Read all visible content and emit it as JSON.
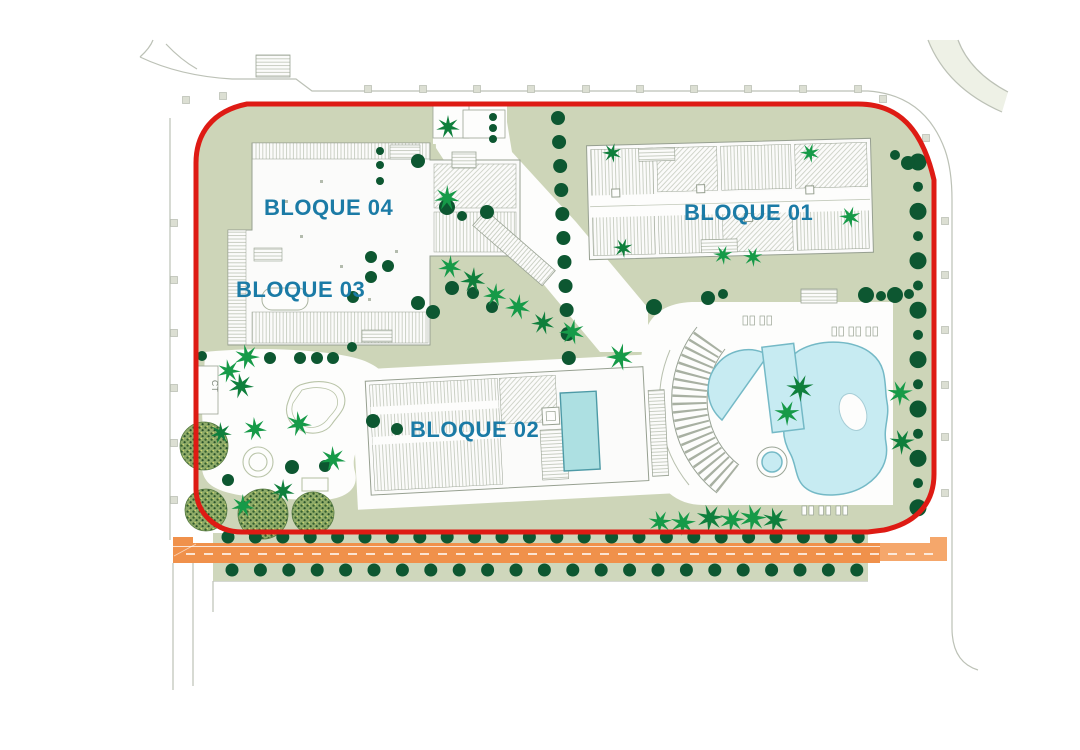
{
  "plan": {
    "buildings": [
      {
        "id": "bloque01",
        "label": "BLOQUE 01"
      },
      {
        "id": "bloque02",
        "label": "BLOQUE 02"
      },
      {
        "id": "bloque03",
        "label": "BLOQUE 03"
      },
      {
        "id": "bloque04",
        "label": "BLOQUE 04"
      }
    ],
    "annotations": {
      "ct_label": "CT"
    },
    "colors": {
      "boundary_red": "#de1b14",
      "label_blue": "#1b7ba6",
      "sage_green": "#cdd5b8",
      "pool_cyan": "#c7ebf2",
      "rooftop_pool_cyan": "#ade0e2",
      "road_orange": "#f0914b",
      "road_orange_light": "#f5a76b",
      "tree_dark_green": "#0d5731",
      "palm_green": "#169a48"
    }
  }
}
